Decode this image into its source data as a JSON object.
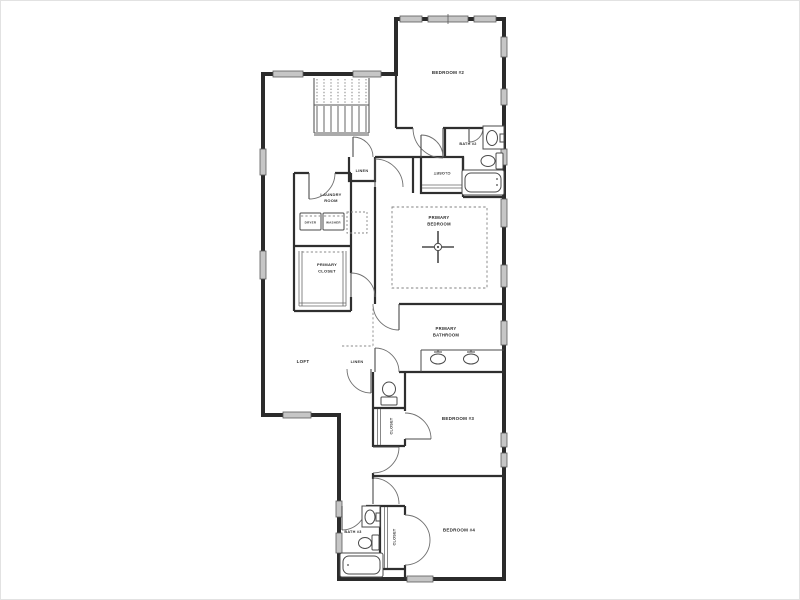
{
  "floorplan": {
    "background": "#ffffff",
    "wall_color": "#2b2b2b",
    "window_color": "#c6c6c6",
    "label_color": "#2b2b2b",
    "rooms": {
      "bedroom2": {
        "label": "BEDROOM #2"
      },
      "bath2": {
        "label": "BATH #2"
      },
      "hall_closet": {
        "label": "CLOSET"
      },
      "linen_upper": {
        "label": "LINEN"
      },
      "laundry": {
        "line1": "LAUNDRY",
        "line2": "ROOM"
      },
      "dryer": {
        "label": "DRYER"
      },
      "washer": {
        "label": "WASHER"
      },
      "primary_closet": {
        "line1": "PRIMARY",
        "line2": "CLOSET"
      },
      "primary_bedroom": {
        "line1": "PRIMARY",
        "line2": "BEDROOM"
      },
      "primary_bathroom": {
        "line1": "PRIMARY",
        "line2": "BATHROOM"
      },
      "loft": {
        "label": "LOFT"
      },
      "linen_lower": {
        "label": "LINEN"
      },
      "bedroom3": {
        "label": "BEDROOM #3"
      },
      "bedroom3_closet": {
        "label": "CLOSET"
      },
      "bath3": {
        "label": "BATH #3"
      },
      "bedroom4_closet": {
        "label": "CLOSET"
      },
      "bedroom4": {
        "label": "BEDROOM #4"
      }
    }
  }
}
